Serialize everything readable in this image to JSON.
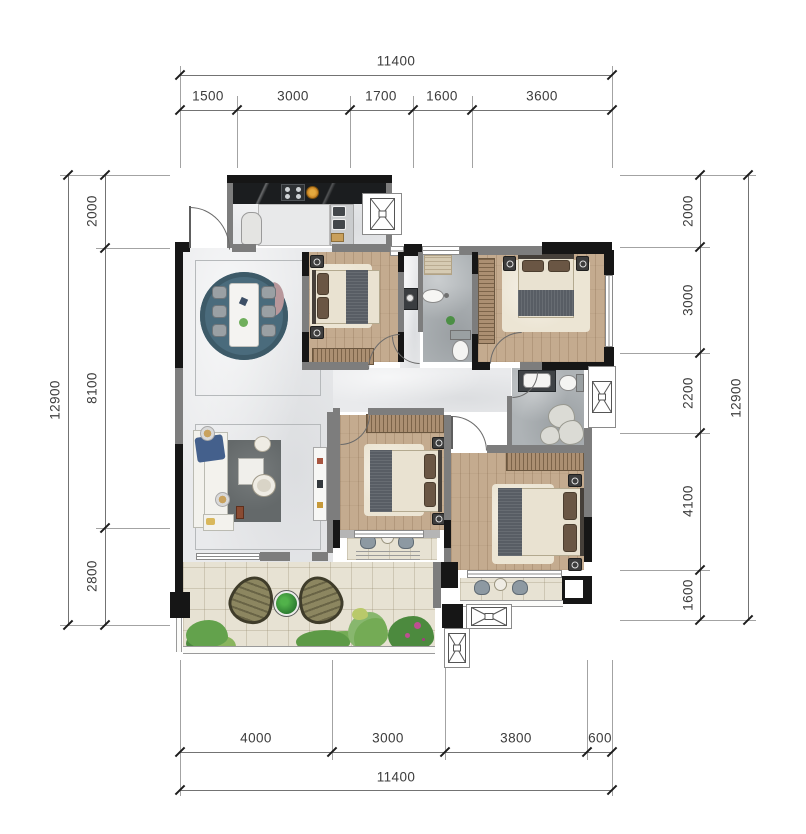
{
  "dimensions": {
    "top": {
      "total": "11400",
      "segments": [
        "1500",
        "3000",
        "1700",
        "1600",
        "3600"
      ]
    },
    "bottom": {
      "total": "11400",
      "segments": [
        "4000",
        "3000",
        "3800",
        "600"
      ]
    },
    "left": {
      "total": "12900",
      "segments": [
        "2000",
        "8100",
        "2800"
      ]
    },
    "right": {
      "total": "12900",
      "segments": [
        "2000",
        "3000",
        "2200",
        "4100",
        "1600"
      ]
    }
  },
  "colors": {
    "wall_exterior": "#161616",
    "wall_interior": "#7d7d7d",
    "floor_marble": "#e9eaec",
    "floor_wood": "#c4ab8f",
    "floor_stone": "#aeb3b6",
    "floor_tile": "#e7e2d3",
    "rug_dining": "#4a6b7c",
    "rug_living": "#64696a",
    "counter_marble_black": "#1b1d1f",
    "bed_blanket": "#585d64",
    "sofa_accent_blue": "#44608c",
    "terrace_chair_olive": "#8c8660",
    "plant_green": "#5d9a46",
    "plant_pink": "#bd4f92"
  }
}
